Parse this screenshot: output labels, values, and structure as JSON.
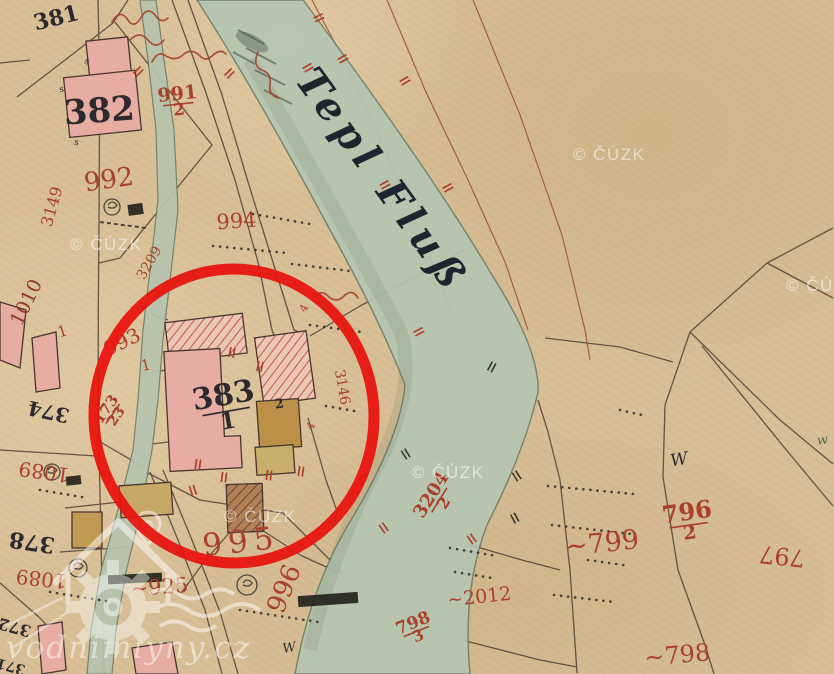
{
  "title": "Historical cadastral map with highlighted mill parcel",
  "colors": {
    "paper": "#d8bf96",
    "ink": "#2c2a2e",
    "red_ink": "#a8402c",
    "dark_red_ink": "#8f3a28",
    "water": "#b5c6b1",
    "annotation_red": "#e81510",
    "watermark": "#ffffff"
  },
  "river": {
    "label": "Tepl Fluß"
  },
  "watermark": {
    "copyright": "© ČÚZK",
    "site": "vodnimlyny.cz",
    "cuzk_positions": [
      {
        "x": 70,
        "y": 250
      },
      {
        "x": 573,
        "y": 160
      },
      {
        "x": 786,
        "y": 291
      },
      {
        "x": 412,
        "y": 478
      },
      {
        "x": 224,
        "y": 522
      }
    ]
  },
  "annotation": {
    "shape": "ellipse",
    "cx": 234,
    "cy": 416,
    "rx": 140,
    "ry": 147,
    "stroke_width": 11,
    "color": "#e81510"
  },
  "labels": {
    "black": [
      {
        "t": "381",
        "x": 58,
        "y": 25,
        "r": -14,
        "s": 22,
        "b": 1
      },
      {
        "t": "382",
        "x": 100,
        "y": 122,
        "r": -4,
        "s": 34,
        "b": 1
      },
      {
        "t": "2",
        "x": 280,
        "y": 408,
        "r": -10,
        "s": 13,
        "b": 1
      },
      {
        "t": "374",
        "x": 50,
        "y": 405,
        "r": 192,
        "s": 20,
        "b": 1
      },
      {
        "t": "378",
        "x": 33,
        "y": 535,
        "r": 188,
        "s": 22,
        "b": 1
      },
      {
        "t": "372",
        "x": 16,
        "y": 622,
        "r": 195,
        "s": 16,
        "b": 1
      },
      {
        "t": "371",
        "x": 12,
        "y": 662,
        "r": 195,
        "s": 14,
        "b": 1
      },
      {
        "t": "W",
        "x": 680,
        "y": 465,
        "r": -10,
        "s": 17,
        "i": 1
      },
      {
        "t": "W",
        "x": 290,
        "y": 652,
        "r": -10,
        "s": 13,
        "i": 1
      },
      {
        "t": "w",
        "x": 823,
        "y": 444,
        "r": -8,
        "s": 13,
        "i": 1,
        "c": "#4a6b4a"
      },
      {
        "t": "s",
        "x": 86,
        "y": 64,
        "r": 20,
        "s": 9
      },
      {
        "t": "s",
        "x": 62,
        "y": 92,
        "r": -10,
        "s": 9
      },
      {
        "t": "s",
        "x": 76,
        "y": 145,
        "r": 10,
        "s": 9
      }
    ],
    "red": [
      {
        "t": "992",
        "x": 110,
        "y": 188,
        "r": -8,
        "s": 26
      },
      {
        "t": "993",
        "x": 125,
        "y": 348,
        "r": -26,
        "s": 20
      },
      {
        "t": "994",
        "x": 237,
        "y": 228,
        "r": -4,
        "s": 21
      },
      {
        "t": "995",
        "x": 242,
        "y": 552,
        "r": -6,
        "s": 31,
        "sp": 6
      },
      {
        "t": "996",
        "x": 292,
        "y": 592,
        "r": -68,
        "s": 26
      },
      {
        "t": "3149",
        "x": 57,
        "y": 208,
        "r": -74,
        "s": 16
      },
      {
        "t": "3209",
        "x": 153,
        "y": 265,
        "r": -60,
        "s": 14
      },
      {
        "t": "1010",
        "x": 32,
        "y": 305,
        "r": -64,
        "s": 19,
        "c": "#8f3a28"
      },
      {
        "t": "1",
        "x": 64,
        "y": 336,
        "r": -18,
        "s": 15
      },
      {
        "t": "1",
        "x": 147,
        "y": 370,
        "r": -14,
        "s": 15
      },
      {
        "t": "1089",
        "x": 45,
        "y": 465,
        "r": 188,
        "s": 20
      },
      {
        "t": "1089",
        "x": 42,
        "y": 572,
        "r": 186,
        "s": 20
      },
      {
        "t": "~925",
        "x": 160,
        "y": 594,
        "r": -4,
        "s": 21
      },
      {
        "t": "~799",
        "x": 603,
        "y": 552,
        "r": -6,
        "s": 27
      },
      {
        "t": "797",
        "x": 783,
        "y": 548,
        "r": 186,
        "s": 24
      },
      {
        "t": "~798",
        "x": 678,
        "y": 663,
        "r": -5,
        "s": 24
      },
      {
        "t": "~2012",
        "x": 480,
        "y": 603,
        "r": -6,
        "s": 19
      },
      {
        "t": "3146",
        "x": 338,
        "y": 388,
        "r": 80,
        "s": 14
      },
      {
        "t": "4",
        "x": 307,
        "y": 310,
        "r": -60,
        "s": 11
      },
      {
        "t": "4",
        "x": 314,
        "y": 428,
        "r": -60,
        "s": 11
      }
    ],
    "fractions": [
      {
        "num": "383",
        "den": "1",
        "x": 225,
        "y": 405,
        "r": -10,
        "s": 30,
        "c": "#2c2a2e"
      },
      {
        "num": "991",
        "den": "2",
        "x": 178,
        "y": 100,
        "r": -6,
        "s": 19
      },
      {
        "num": "796",
        "den": "2",
        "x": 688,
        "y": 520,
        "r": -8,
        "s": 24
      },
      {
        "num": "3204",
        "den": "2",
        "x": 436,
        "y": 498,
        "r": -58,
        "s": 18
      },
      {
        "num": "798",
        "den": "3",
        "x": 415,
        "y": 628,
        "r": -22,
        "s": 17
      },
      {
        "num": "173",
        "den": "23",
        "x": 110,
        "y": 412,
        "r": -55,
        "s": 15
      }
    ]
  }
}
